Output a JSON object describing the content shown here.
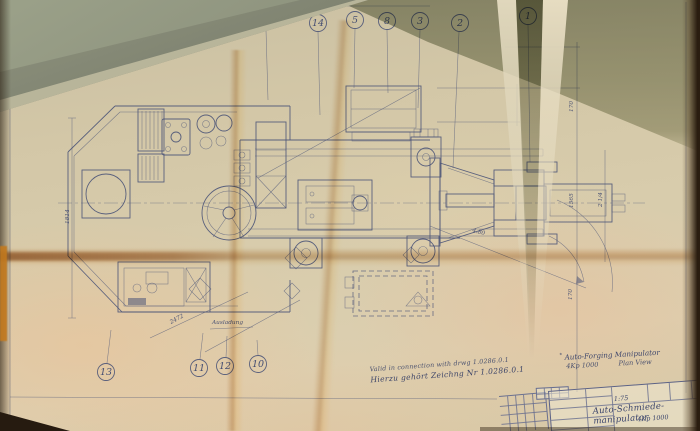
{
  "balloons": {
    "top": [
      "15",
      "14",
      "5",
      "8",
      "3",
      "2",
      "1"
    ],
    "bottom": [
      "13",
      "11",
      "12",
      "10"
    ]
  },
  "dimensions": {
    "left_height": "1814",
    "boom_reach": "2472",
    "boom_label": "Ausladung",
    "right_top": "170",
    "right_mid_a": "1565",
    "right_mid_b": "2 1/4",
    "swing_angle": "4.80",
    "right_bottom": "170"
  },
  "notes": {
    "validity_en": "Valid in connection with drwg 1.0286.0.1",
    "validity_de": "Hierzu gehört Zeichng Nr  1.0286.0.1",
    "title_mark": "*",
    "title_en": "Auto-Forging Manipulator",
    "model": "4Kp 1000",
    "view": "Plan View"
  },
  "title_block": {
    "scale": "1:75",
    "title_de": "Auto-Schmiede-manipulator",
    "model": "4Kp 1000"
  }
}
